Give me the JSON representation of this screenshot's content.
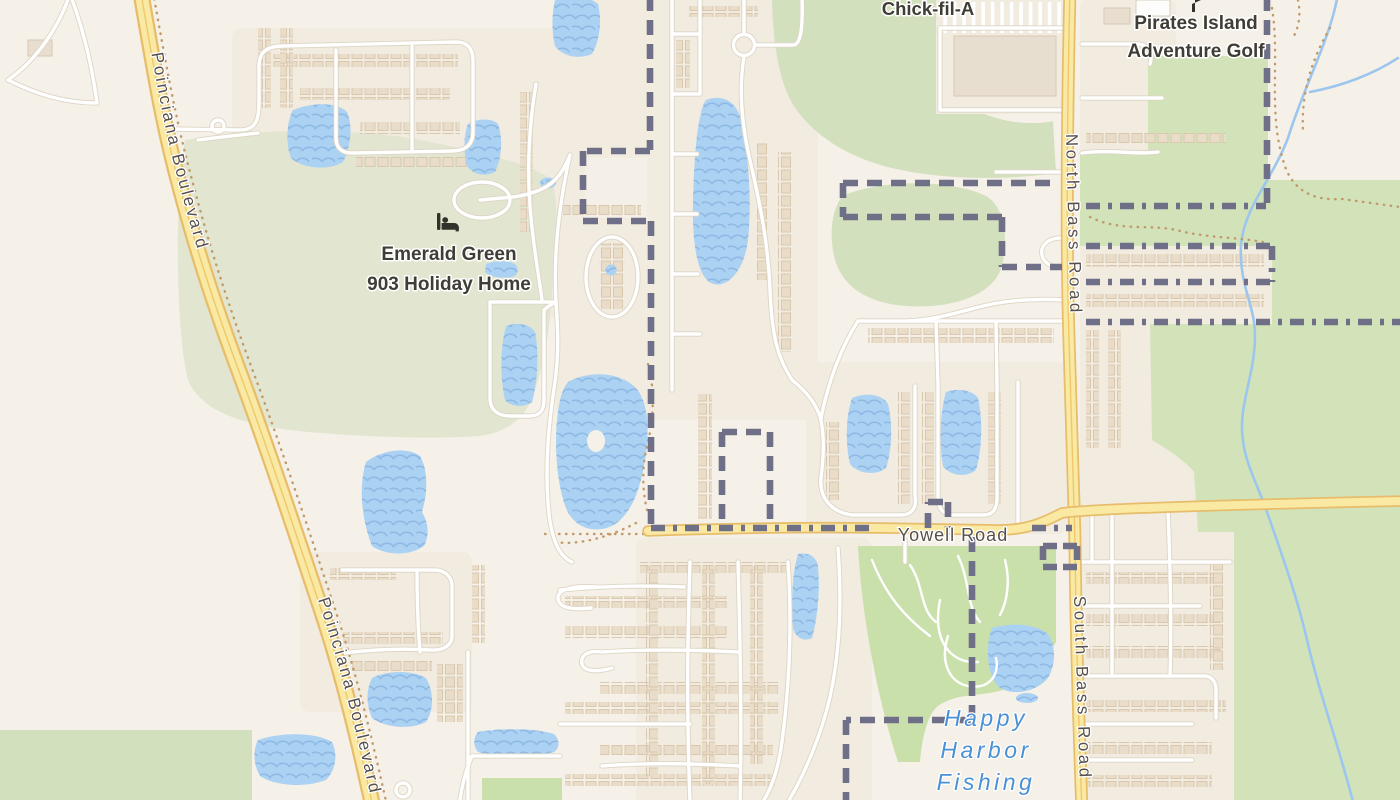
{
  "map": {
    "labels": {
      "poinciana_top": "Poinciana Boulevard",
      "poinciana_bottom": "Poinciana Boulevard",
      "north_bass": "North Bass Road",
      "south_bass": "South Bass Road",
      "yowell": "Yowell Road",
      "chick_fil_a": "Chick-fil-A",
      "pirates_line1": "Pirates Island",
      "pirates_line2": "Adventure Golf",
      "emerald_line1": "Emerald Green",
      "emerald_line2": "903 Holiday Home",
      "happy_line1": "Happy",
      "happy_line2": "Harbor",
      "happy_line3": "Fishing"
    },
    "icons": [
      {
        "name": "lodging-icon",
        "meaning": "bed / holiday home"
      },
      {
        "name": "golf-flag-icon",
        "meaning": "adventure golf"
      }
    ],
    "colors": {
      "bg": "#f6f1e8",
      "residential": "#f1ebe0",
      "block": "#f5f0e7",
      "sageGreen": "#e2e6d0",
      "parkGreen": "#d3e0bd",
      "bigGreen": "#d2e3ba",
      "brightGreen": "#c9e0ab",
      "water": "#abd2f2",
      "wave": "#8fb9e4",
      "stream": "#9cc6ee",
      "roadWhite": "#ffffff",
      "roadCasing": "#ddd5c5",
      "yellowFill": "#fae9a2",
      "yellowCasing": "#e7bd6b",
      "yellowMid": "#eec86f",
      "boundary": "#6f7088",
      "trail": "#c09a6a",
      "building": "#e9dcc8",
      "buildingStroke": "#d9c8ae",
      "labelRoad": "#57504a",
      "labelPoi": "#3f3d36",
      "labelWater": "#4a90d6",
      "icon": "#32322b"
    }
  }
}
